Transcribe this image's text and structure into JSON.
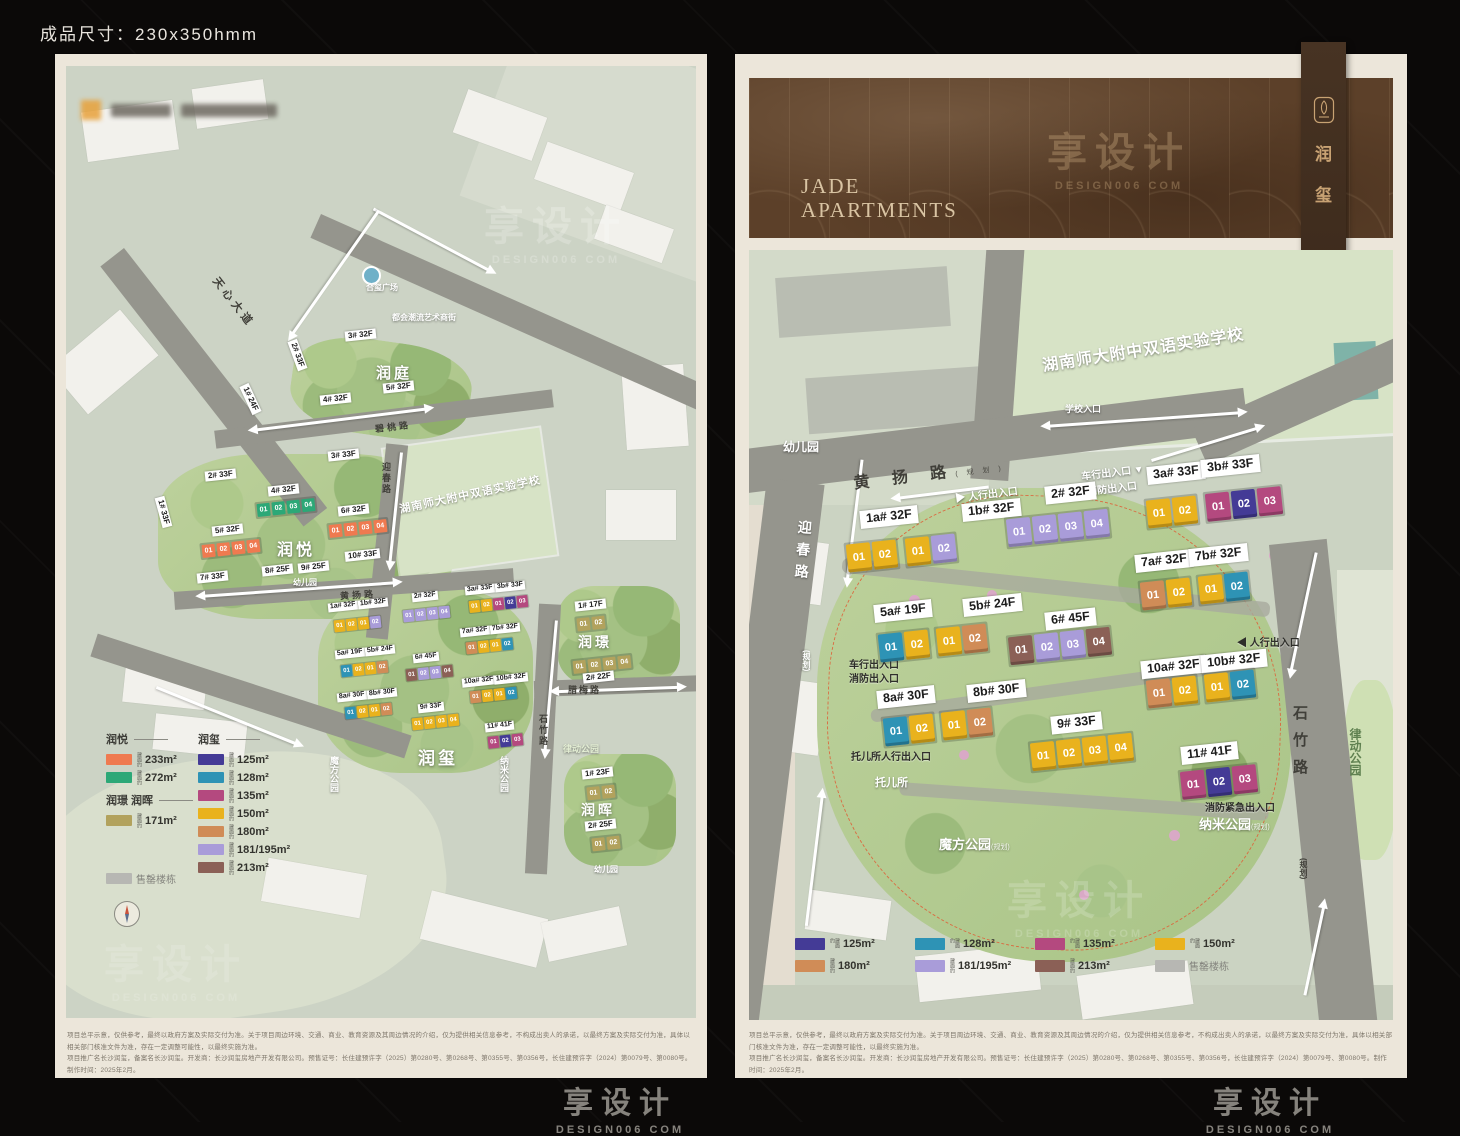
{
  "page": {
    "size_label": "成品尺寸：230x350hmm",
    "watermark_cn": "享设计",
    "watermark_en": "DESIGN006 COM"
  },
  "colors": {
    "coral": "#ef7a50",
    "green": "#2ca877",
    "tan": "#b2a25d",
    "gray": "#b7b7b3",
    "navy": "#443b96",
    "teal": "#2e93b5",
    "magenta": "#b4497f",
    "yellow": "#e9b21d",
    "orange": "#d08c57",
    "purple": "#a99cd9",
    "brown": "#8b6056"
  },
  "header": {
    "title_en_1": "JADE",
    "title_en_2": "APARTMENTS",
    "ribbon_name_1": "润",
    "ribbon_name_2": "玺"
  },
  "disclaimer": {
    "line1": "项目总平示意，仅供参考，最终以政府方案及实际交付为准。关于项目周边环境、交通、商业、教育资源及其周边情况的介绍，仅为提供相关信息参考，不构成出卖人的承诺，以最终方案及实际交付为准，具体以相关部门核准文件为准，存在一定调整可能性，以最终实施为准。",
    "line2": "项目推广名长沙润玺，备案名长沙润玺。开发商：长沙润玺房地产开发有限公司。预售证号：长住建预许字（2025）第0280号、第0268号、第0355号、第0356号，长住建预许字（2024）第0079号、第0080号。制作时间：2025年2月。"
  },
  "legend": {
    "area_prefix": "建面约",
    "left_groups": {
      "g1_title": "润悦",
      "g1": [
        {
          "c": "coral",
          "a": "233m²"
        },
        {
          "c": "green",
          "a": "272m²"
        }
      ],
      "g2_title": "润璟 润晖",
      "g2": [
        {
          "c": "tan",
          "a": "171m²"
        }
      ],
      "sold": {
        "c": "gray",
        "a": "售罄楼栋"
      },
      "g3_title": "润玺",
      "g3": [
        {
          "c": "navy",
          "a": "125m²"
        },
        {
          "c": "teal",
          "a": "128m²"
        },
        {
          "c": "magenta",
          "a": "135m²"
        },
        {
          "c": "yellow",
          "a": "150m²"
        },
        {
          "c": "orange",
          "a": "180m²"
        },
        {
          "c": "purple",
          "a": "181/195m²"
        },
        {
          "c": "brown",
          "a": "213m²"
        }
      ]
    },
    "right_items": [
      {
        "c": "navy",
        "a": "125m²"
      },
      {
        "c": "teal",
        "a": "128m²"
      },
      {
        "c": "magenta",
        "a": "135m²"
      },
      {
        "c": "yellow",
        "a": "150m²"
      },
      {
        "c": "orange",
        "a": "180m²"
      },
      {
        "c": "purple",
        "a": "181/195m²"
      },
      {
        "c": "brown",
        "a": "213m²"
      },
      {
        "c": "gray",
        "a": "售罄楼栋"
      }
    ]
  },
  "left_map": {
    "roads": {
      "tianxin": "天心大道",
      "bitao": "碧桃路",
      "huangyang": "黄扬路",
      "yingchun": "迎春路",
      "shizhu": "石竹路",
      "lamei": "腊梅路"
    },
    "plaza": "合玺广场",
    "street": "都会潮流艺术商街",
    "school": "湖南师大附中双语实验学校",
    "districts": {
      "runting": "润庭",
      "runyue": "润悦",
      "runxi": "润玺",
      "runjing": "润璟",
      "runhui": "润晖"
    },
    "kindergarten": "幼儿园",
    "parks": {
      "mofang": "魔方公园",
      "nami": "纳米公园",
      "lvdong": "律动公园"
    },
    "runting_buildings": [
      "1# 24F",
      "2# 33F",
      "3# 32F",
      "4# 32F",
      "5# 32F"
    ],
    "runyue_buildings": [
      "1# 33F",
      "2# 33F",
      "3# 33F",
      "4# 32F",
      "5# 32F",
      "6# 32F",
      "7# 33F",
      "8# 25F",
      "9# 25F",
      "10# 33F"
    ],
    "runyue_units": {
      "b4": [
        {
          "n": "01",
          "c": "green"
        },
        {
          "n": "02",
          "c": "green"
        },
        {
          "n": "03",
          "c": "green"
        },
        {
          "n": "04",
          "c": "green"
        }
      ],
      "b5": [
        {
          "n": "01",
          "c": "coral"
        },
        {
          "n": "02",
          "c": "coral"
        },
        {
          "n": "03",
          "c": "coral"
        },
        {
          "n": "04",
          "c": "coral"
        }
      ],
      "b6": [
        {
          "n": "01",
          "c": "coral"
        },
        {
          "n": "02",
          "c": "coral"
        },
        {
          "n": "03",
          "c": "coral"
        },
        {
          "n": "04",
          "c": "coral"
        }
      ]
    },
    "runxi_units": {
      "r1": [
        {
          "n": "01",
          "c": "yellow"
        },
        {
          "n": "02",
          "c": "yellow"
        },
        {
          "n": "01",
          "c": "yellow"
        },
        {
          "n": "02",
          "c": "purple"
        }
      ],
      "r2": [
        {
          "n": "01",
          "c": "purple"
        },
        {
          "n": "02",
          "c": "purple"
        },
        {
          "n": "03",
          "c": "purple"
        },
        {
          "n": "04",
          "c": "purple"
        }
      ],
      "r3": [
        {
          "n": "01",
          "c": "yellow"
        },
        {
          "n": "02",
          "c": "yellow"
        },
        {
          "n": "01",
          "c": "magenta"
        },
        {
          "n": "02",
          "c": "navy"
        },
        {
          "n": "03",
          "c": "magenta"
        }
      ],
      "r5": [
        {
          "n": "01",
          "c": "teal"
        },
        {
          "n": "02",
          "c": "yellow"
        },
        {
          "n": "01",
          "c": "yellow"
        },
        {
          "n": "02",
          "c": "orange"
        }
      ],
      "r6": [
        {
          "n": "01",
          "c": "brown"
        },
        {
          "n": "02",
          "c": "purple"
        },
        {
          "n": "03",
          "c": "purple"
        },
        {
          "n": "04",
          "c": "brown"
        }
      ],
      "r7": [
        {
          "n": "01",
          "c": "orange"
        },
        {
          "n": "02",
          "c": "yellow"
        },
        {
          "n": "01",
          "c": "yellow"
        },
        {
          "n": "02",
          "c": "teal"
        }
      ],
      "r8": [
        {
          "n": "01",
          "c": "teal"
        },
        {
          "n": "02",
          "c": "yellow"
        },
        {
          "n": "01",
          "c": "yellow"
        },
        {
          "n": "02",
          "c": "orange"
        }
      ],
      "r9": [
        {
          "n": "01",
          "c": "yellow"
        },
        {
          "n": "02",
          "c": "yellow"
        },
        {
          "n": "03",
          "c": "yellow"
        },
        {
          "n": "04",
          "c": "yellow"
        }
      ],
      "r10": [
        {
          "n": "01",
          "c": "orange"
        },
        {
          "n": "02",
          "c": "yellow"
        },
        {
          "n": "01",
          "c": "yellow"
        },
        {
          "n": "02",
          "c": "teal"
        }
      ],
      "r11": [
        {
          "n": "01",
          "c": "magenta"
        },
        {
          "n": "02",
          "c": "navy"
        },
        {
          "n": "03",
          "c": "magenta"
        }
      ]
    },
    "runjing_buildings": [
      "1# 17F",
      "2# 22F"
    ],
    "runjing_units": {
      "r1": [
        {
          "n": "01",
          "c": "tan"
        },
        {
          "n": "02",
          "c": "tan"
        }
      ],
      "r2": [
        {
          "n": "01",
          "c": "tan"
        },
        {
          "n": "02",
          "c": "tan"
        },
        {
          "n": "03",
          "c": "tan"
        },
        {
          "n": "04",
          "c": "tan"
        }
      ]
    },
    "runhui_buildings": [
      "1# 23F",
      "2# 25F"
    ],
    "runhui_units": {
      "r1": [
        {
          "n": "01",
          "c": "tan"
        },
        {
          "n": "02",
          "c": "tan"
        }
      ],
      "r2": [
        {
          "n": "01",
          "c": "tan"
        },
        {
          "n": "02",
          "c": "tan"
        }
      ]
    }
  },
  "right_map": {
    "roads": {
      "huangyang": "黄 扬 路",
      "yingchun": "迎春路",
      "shizhu": "石竹路",
      "plan": "(规划)"
    },
    "school": "湖南师大附中双语实验学校",
    "school_gate": "学校入口",
    "kindergarten": "幼儿园",
    "nursery": "托儿所",
    "parks": {
      "mofang": "魔方公园",
      "nami": "纳米公园",
      "lvdong": "律动公园",
      "plan": "(规划)"
    },
    "entrances": {
      "ped": "人行出入口",
      "veh": "车行出入口",
      "fire": "消防出入口",
      "nursery_ped": "托儿所人行出入口",
      "fire_emg": "消防紧急出入口"
    },
    "buildings": {
      "b1a": {
        "label": "1a# 32F",
        "units": [
          {
            "n": "01",
            "c": "yellow"
          },
          {
            "n": "02",
            "c": "yellow"
          }
        ]
      },
      "b1b": {
        "label": "1b# 32F",
        "units": [
          {
            "n": "01",
            "c": "yellow"
          },
          {
            "n": "02",
            "c": "purple"
          }
        ]
      },
      "b2": {
        "label": "2# 32F",
        "units": [
          {
            "n": "01",
            "c": "purple"
          },
          {
            "n": "02",
            "c": "purple"
          },
          {
            "n": "03",
            "c": "purple"
          },
          {
            "n": "04",
            "c": "purple"
          }
        ]
      },
      "b3a": {
        "label": "3a# 33F",
        "units": [
          {
            "n": "01",
            "c": "yellow"
          },
          {
            "n": "02",
            "c": "yellow"
          }
        ]
      },
      "b3b": {
        "label": "3b# 33F",
        "units": [
          {
            "n": "01",
            "c": "magenta"
          },
          {
            "n": "02",
            "c": "navy"
          },
          {
            "n": "03",
            "c": "magenta"
          }
        ]
      },
      "b5a": {
        "label": "5a# 19F",
        "units": [
          {
            "n": "01",
            "c": "teal"
          },
          {
            "n": "02",
            "c": "yellow"
          }
        ]
      },
      "b5b": {
        "label": "5b# 24F",
        "units": [
          {
            "n": "01",
            "c": "yellow"
          },
          {
            "n": "02",
            "c": "orange"
          }
        ]
      },
      "b6": {
        "label": "6# 45F",
        "units": [
          {
            "n": "01",
            "c": "brown"
          },
          {
            "n": "02",
            "c": "purple"
          },
          {
            "n": "03",
            "c": "purple"
          },
          {
            "n": "04",
            "c": "brown"
          }
        ]
      },
      "b7a": {
        "label": "7a# 32F",
        "units": [
          {
            "n": "01",
            "c": "orange"
          },
          {
            "n": "02",
            "c": "yellow"
          }
        ]
      },
      "b7b": {
        "label": "7b# 32F",
        "units": [
          {
            "n": "01",
            "c": "yellow"
          },
          {
            "n": "02",
            "c": "teal"
          }
        ]
      },
      "b8a": {
        "label": "8a# 30F",
        "units": [
          {
            "n": "01",
            "c": "teal"
          },
          {
            "n": "02",
            "c": "yellow"
          }
        ]
      },
      "b8b": {
        "label": "8b# 30F",
        "units": [
          {
            "n": "01",
            "c": "yellow"
          },
          {
            "n": "02",
            "c": "orange"
          }
        ]
      },
      "b9": {
        "label": "9# 33F",
        "units": [
          {
            "n": "01",
            "c": "yellow"
          },
          {
            "n": "02",
            "c": "yellow"
          },
          {
            "n": "03",
            "c": "yellow"
          },
          {
            "n": "04",
            "c": "yellow"
          }
        ]
      },
      "b10a": {
        "label": "10a# 32F",
        "units": [
          {
            "n": "01",
            "c": "orange"
          },
          {
            "n": "02",
            "c": "yellow"
          }
        ]
      },
      "b10b": {
        "label": "10b# 32F",
        "units": [
          {
            "n": "01",
            "c": "yellow"
          },
          {
            "n": "02",
            "c": "teal"
          }
        ]
      },
      "b11": {
        "label": "11# 41F",
        "units": [
          {
            "n": "01",
            "c": "magenta"
          },
          {
            "n": "02",
            "c": "navy"
          },
          {
            "n": "03",
            "c": "magenta"
          }
        ]
      }
    }
  }
}
